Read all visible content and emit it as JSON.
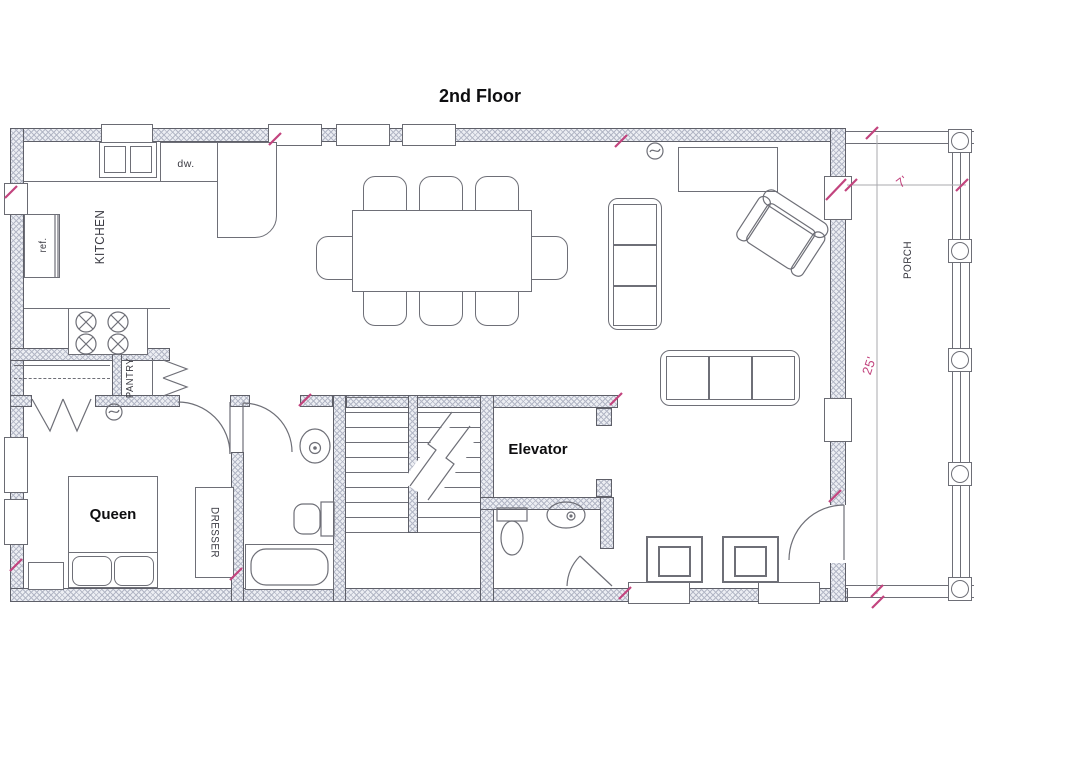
{
  "title": "2nd Floor",
  "rooms": {
    "kitchen": "KITCHEN",
    "pantry": "PANTRY",
    "porch": "PORCH",
    "bedroom": "Queen",
    "elevator": "Elevator"
  },
  "fixtures": {
    "refrigerator": "ref.",
    "dishwasher": "dw.",
    "dresser": "DRESSER"
  },
  "dimensions": {
    "porch_depth": "7'",
    "porch_length": "25'"
  },
  "colors": {
    "dimension_accent": "#c2447e",
    "wall_fill": "#eceef3",
    "hatch_line": "#b3b7c6",
    "drawing_line": "#6e6f77",
    "paper": "#ffffff",
    "label_text": "#0e0e10"
  }
}
